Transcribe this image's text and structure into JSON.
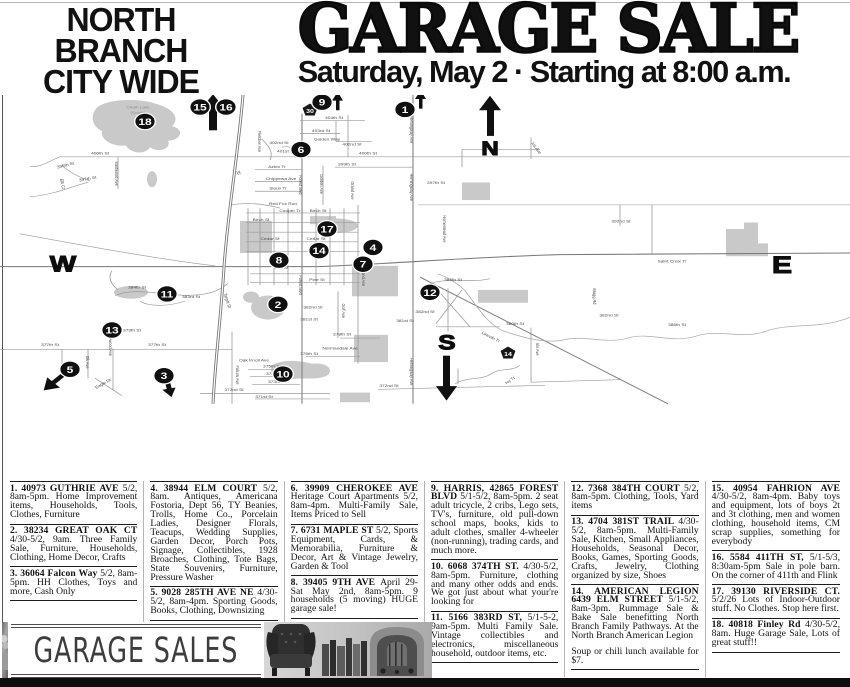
{
  "header": {
    "kicker_lines": [
      "NORTH",
      "BRANCH",
      "CITY WIDE"
    ],
    "title": "GARAGE SALE",
    "subtitle": "Saturday, May 2 · Starting at 8:00 a.m."
  },
  "map": {
    "compass": {
      "north": "N",
      "south": "S",
      "east": "E",
      "west": "W"
    },
    "shields": [
      {
        "label": "30",
        "x": 310,
        "y": 114
      },
      {
        "label": "14",
        "x": 508,
        "y": 417
      }
    ],
    "markers": [
      {
        "n": "1",
        "x": 405,
        "y": 113
      },
      {
        "n": "2",
        "x": 278,
        "y": 356
      },
      {
        "n": "3",
        "x": 164,
        "y": 445
      },
      {
        "n": "4",
        "x": 373,
        "y": 285
      },
      {
        "n": "5",
        "x": 70,
        "y": 437
      },
      {
        "n": "6",
        "x": 301,
        "y": 163
      },
      {
        "n": "7",
        "x": 363,
        "y": 306
      },
      {
        "n": "8",
        "x": 279,
        "y": 301
      },
      {
        "n": "9",
        "x": 322,
        "y": 104
      },
      {
        "n": "10",
        "x": 283,
        "y": 443
      },
      {
        "n": "11",
        "x": 167,
        "y": 343
      },
      {
        "n": "12",
        "x": 430,
        "y": 341
      },
      {
        "n": "13",
        "x": 112,
        "y": 388
      },
      {
        "n": "14",
        "x": 319,
        "y": 289
      },
      {
        "n": "15",
        "x": 200,
        "y": 110
      },
      {
        "n": "16",
        "x": 226,
        "y": 110
      },
      {
        "n": "17",
        "x": 327,
        "y": 262
      },
      {
        "n": "18",
        "x": 145,
        "y": 128
      }
    ],
    "street_labels": [
      {
        "t": "Chain Lake",
        "x": 138,
        "y": 112,
        "r": 0,
        "lake": true
      },
      {
        "t": "(South)",
        "x": 138,
        "y": 119,
        "r": 0,
        "lake": true
      },
      {
        "t": "400th St",
        "x": 100,
        "y": 169,
        "r": 0
      },
      {
        "t": "399th St",
        "x": 66,
        "y": 184,
        "r": -18
      },
      {
        "t": "397th St",
        "x": 88,
        "y": 201,
        "r": -12
      },
      {
        "t": "Elk Ct",
        "x": 61,
        "y": 206,
        "r": 80
      },
      {
        "t": "Eastwood Ave",
        "x": 115,
        "y": 193,
        "r": 90
      },
      {
        "t": "Fletcher Ave",
        "x": 258,
        "y": 153,
        "r": 90
      },
      {
        "t": "402nd St",
        "x": 279,
        "y": 156,
        "r": 0
      },
      {
        "t": "401st Ct",
        "x": 286,
        "y": 167,
        "r": 0
      },
      {
        "t": "404th St",
        "x": 334,
        "y": 125,
        "r": 0
      },
      {
        "t": "403rd St",
        "x": 321,
        "y": 141,
        "r": 0
      },
      {
        "t": "Golden Way",
        "x": 327,
        "y": 152,
        "r": 0
      },
      {
        "t": "402nd St",
        "x": 352,
        "y": 158,
        "r": 0
      },
      {
        "t": "400th St",
        "x": 368,
        "y": 169,
        "r": 0
      },
      {
        "t": "399th St",
        "x": 347,
        "y": 183,
        "r": 0
      },
      {
        "t": "Golden Ave",
        "x": 320,
        "y": 206,
        "r": 90
      },
      {
        "t": "Grand Ave",
        "x": 351,
        "y": 214,
        "r": 90
      },
      {
        "t": "Hemingway Ave",
        "x": 410,
        "y": 138,
        "r": 90
      },
      {
        "t": "Hemingway Ave",
        "x": 410,
        "y": 210,
        "r": 90
      },
      {
        "t": "397th St",
        "x": 436,
        "y": 206,
        "r": 0
      },
      {
        "t": "Iris Ave",
        "x": 535,
        "y": 162,
        "r": 60
      },
      {
        "t": "Aztec Tr",
        "x": 277,
        "y": 186,
        "r": 0
      },
      {
        "t": "Chippewa Ave",
        "x": 281,
        "y": 201,
        "r": 0
      },
      {
        "t": "Sioux Tr",
        "x": 278,
        "y": 213,
        "r": 0
      },
      {
        "t": "Forest Blvd",
        "x": 299,
        "y": 207,
        "r": 90
      },
      {
        "t": "Forest Blvd",
        "x": 299,
        "y": 332,
        "r": 90
      },
      {
        "t": "35",
        "x": 237,
        "y": 192,
        "r": 80
      },
      {
        "t": "Red Fox Run",
        "x": 283,
        "y": 232,
        "r": 0
      },
      {
        "t": "Cooper Tr",
        "x": 290,
        "y": 241,
        "r": 0
      },
      {
        "t": "Birch St",
        "x": 318,
        "y": 241,
        "r": 0
      },
      {
        "t": "Birch St",
        "x": 261,
        "y": 252,
        "r": 0
      },
      {
        "t": "Cedar St",
        "x": 270,
        "y": 276,
        "r": 0
      },
      {
        "t": "Cedar St",
        "x": 316,
        "y": 276,
        "r": 0
      },
      {
        "t": "Oak St",
        "x": 281,
        "y": 312,
        "r": 0
      },
      {
        "t": "Pine St",
        "x": 317,
        "y": 327,
        "r": 0
      },
      {
        "t": "Grand Ave",
        "x": 362,
        "y": 322,
        "r": 90
      },
      {
        "t": "Saint Croix Tr",
        "x": 672,
        "y": 304,
        "r": 0
      },
      {
        "t": "392nd St",
        "x": 621,
        "y": 254,
        "r": 0
      },
      {
        "t": "Homestead Ave",
        "x": 443,
        "y": 262,
        "r": 90
      },
      {
        "t": "385th St",
        "x": 453,
        "y": 327,
        "r": 0
      },
      {
        "t": "384th St",
        "x": 137,
        "y": 336,
        "r": 0
      },
      {
        "t": "383rd St",
        "x": 191,
        "y": 348,
        "r": 0
      },
      {
        "t": "382nd St",
        "x": 425,
        "y": 367,
        "r": 0
      },
      {
        "t": "381st St",
        "x": 405,
        "y": 378,
        "r": 0
      },
      {
        "t": "380th St",
        "x": 515,
        "y": 382,
        "r": 0
      },
      {
        "t": "Lincoln Tr",
        "x": 490,
        "y": 398,
        "r": 33
      },
      {
        "t": "Iris Ave",
        "x": 536,
        "y": 412,
        "r": 90
      },
      {
        "t": "Ivy Tr",
        "x": 511,
        "y": 452,
        "r": -40
      },
      {
        "t": "Bragg Rd",
        "x": 593,
        "y": 346,
        "r": 90
      },
      {
        "t": "386th St",
        "x": 677,
        "y": 383,
        "r": 0
      },
      {
        "t": "382nd St",
        "x": 609,
        "y": 371,
        "r": 0
      },
      {
        "t": "372nd St",
        "x": 389,
        "y": 459,
        "r": 0
      },
      {
        "t": "372nd St",
        "x": 234,
        "y": 464,
        "r": 0
      },
      {
        "t": "371st St",
        "x": 264,
        "y": 473,
        "r": 0
      },
      {
        "t": "373rd St",
        "x": 277,
        "y": 454,
        "r": 0
      },
      {
        "t": "374th St",
        "x": 275,
        "y": 444,
        "r": 0
      },
      {
        "t": "375th St",
        "x": 272,
        "y": 435,
        "r": 0
      },
      {
        "t": "Oak Knoll Ave",
        "x": 254,
        "y": 427,
        "r": 0
      },
      {
        "t": "376th St",
        "x": 309,
        "y": 419,
        "r": 0
      },
      {
        "t": "Normandale Ave",
        "x": 340,
        "y": 412,
        "r": 0
      },
      {
        "t": "Golf Ave",
        "x": 342,
        "y": 364,
        "r": 90
      },
      {
        "t": "Hemingway Ave",
        "x": 410,
        "y": 440,
        "r": 90
      },
      {
        "t": "377th St",
        "x": 157,
        "y": 408,
        "r": 0
      },
      {
        "t": "377th St",
        "x": 50,
        "y": 408,
        "r": 0
      },
      {
        "t": "379th St",
        "x": 132,
        "y": 390,
        "r": 0
      },
      {
        "t": "378th St",
        "x": 342,
        "y": 395,
        "r": 0
      },
      {
        "t": "381st St",
        "x": 309,
        "y": 376,
        "r": 0
      },
      {
        "t": "382nd St",
        "x": 313,
        "y": 361,
        "r": 0
      },
      {
        "t": "Falcon Ave",
        "x": 236,
        "y": 444,
        "r": 90
      },
      {
        "t": "Target Dr",
        "x": 226,
        "y": 352,
        "r": 75
      },
      {
        "t": "Englewood Ave",
        "x": 109,
        "y": 404,
        "r": 90
      },
      {
        "t": "Eagle Dr",
        "x": 104,
        "y": 456,
        "r": -35
      },
      {
        "t": "Elk Ave",
        "x": 86,
        "y": 428,
        "r": 90
      }
    ]
  },
  "listings": {
    "columns": [
      [
        {
          "n": 1,
          "bold": "1. 40973 GUTHRIE AVE",
          "body": "5/2, 8am-5pm. Home Improvement items, Households, Tools, Clothes, Furniture"
        },
        {
          "n": 2,
          "bold": "2. 38234 GREAT OAK CT",
          "body": "4/30-5/2, 9am. Three Family Sale, Furniture, Households, Clothing, Home Decor, Crafts"
        },
        {
          "n": 3,
          "bold": "3. 36064 Falcon Way",
          "body": "5/2, 8am-5pm. HH Clothes, Toys and more, Cash Only"
        }
      ],
      [
        {
          "n": 4,
          "bold": "4. 38944 ELM COURT",
          "body": "5/2, 8am. Antiques, Americana Fostoria, Dept 56, TY Beanies, Trolls, Home Co., Porcelain Ladies, Designer Florals, Teacups, Wedding Supplies, Garden Decor, Porch Pots, Signage, Collectibles, 1928 Broaches, Clothing, Tote Bags, State Souvenirs, Furniture, Pressure Washer"
        },
        {
          "n": 5,
          "bold": "5. 9028 285TH AVE NE",
          "body": "4/30-5/2, 8am-4pm. Sporting Goods, Books, Clothing, Downsizing"
        }
      ],
      [
        {
          "n": 6,
          "bold": "6. 39909 CHEROKEE AVE",
          "body": "Heritage Court Apartments 5/2, 8am-4pm. Multi-Family Sale, Items Priced to Sell"
        },
        {
          "n": 7,
          "bold": "7. 6731 MAPLE ST",
          "body": "5/2, Sports Equipment, Cards, & Memorabilia, Furniture & Decor, Art & Vintage Jewelry, Garden & Tool"
        },
        {
          "n": 8,
          "bold": "8. 39405 9TH AVE",
          "body": "April 29- Sat May 2nd, 8am-5pm. 9 households (5 moving) HUGE garage sale!"
        }
      ],
      [
        {
          "n": 9,
          "bold": "9. HARRIS, 42865 FOREST BLVD",
          "body": "5/1-5/2, 8am-5pm. 2 seat adult tricycle, 2 cribs, Lego sets, TV's, furniture, old pull-down school maps, books, kids to adult clothes, smaller 4-wheeler (non-running), trading cards, and much more."
        },
        {
          "n": 10,
          "bold": "10. 6068 374TH ST.",
          "body": "4/30-5/2, 8am-5pm. Furniture, clothing and many other odds and ends. We got just about what your're looking for"
        },
        {
          "n": 11,
          "bold": "11. 5166 383RD ST,",
          "body": "5/1-5-2, 9am-5pm. Multi Family Sale. Vintage collectibles and electronics, miscellaneous household, outdoor items, etc."
        }
      ],
      [
        {
          "n": 12,
          "bold": "12. 7368 384TH COURT",
          "body": "5/2, 8am-5pm. Clothing, Tools, Yard items"
        },
        {
          "n": 13,
          "bold": "13. 4704 381ST TRAIL",
          "body": "4/30-5/2, 8am-5pm. Multi-Family Sale, Kitchen, Small Appliances, Households, Seasonal Decor, Books, Games, Sporting Goods, Crafts, Jewelry, Clothing organized by size, Shoes"
        },
        {
          "n": 14,
          "bold": "14. AMERICAN LEGION 6439 ELM STREET",
          "body": "5/1-5/2, 8am-3pm. Rummage Sale & Bake Sale benefitting North Branch Family Pathways. At the North Branch American Legion",
          "extra": "Soup or chili lunch available for $7."
        }
      ],
      [
        {
          "n": 15,
          "bold": "15. 40954 FAHRION AVE",
          "body": "4/30-5/2, 8am-4pm. Baby toys and equipment, lots of boys 2t and 3t clothing, men and women clothing, household items, CM scrap supplies, something for everybody"
        },
        {
          "n": 16,
          "bold": "16. 5584 411TH ST,",
          "body": "5/1-5/3, 8:30am-5pm Sale in pole barn. On the corner of 411th and Flink"
        },
        {
          "n": 17,
          "bold": "17. 39130 RIVERSIDE CT.",
          "body": "5/2/26 Lots of Indoor-Outdoor stuff. No Clothes. Stop here first."
        },
        {
          "n": 18,
          "bold": "18. 40818 Finley Rd",
          "body": "4/30-5/2, 8am. Huge Garage Sale, Lots of great stuff!!"
        }
      ]
    ]
  },
  "footer": {
    "banner_text": "GARAGE SALES"
  }
}
